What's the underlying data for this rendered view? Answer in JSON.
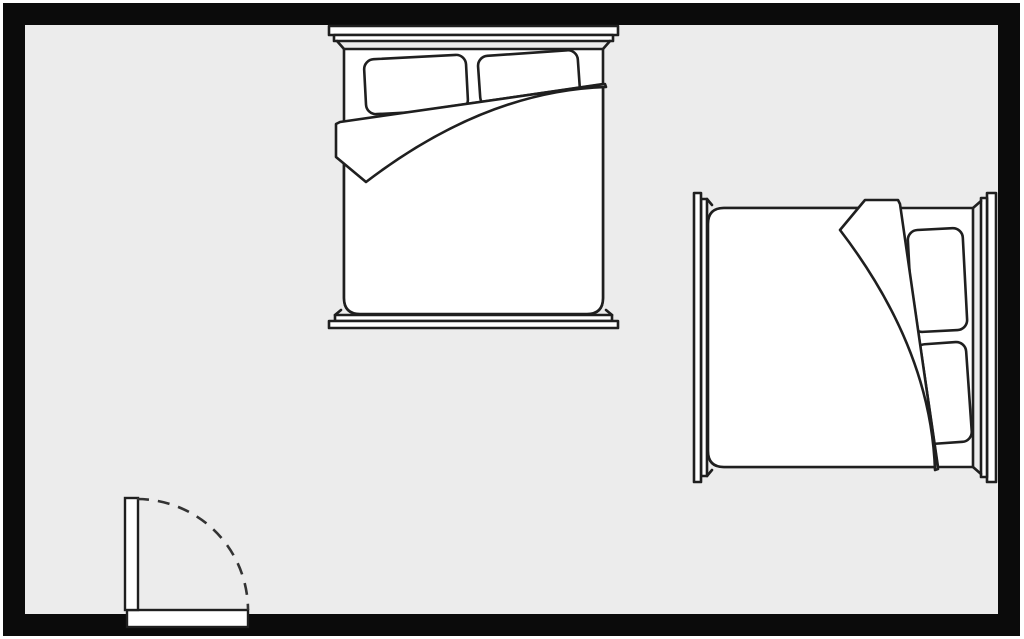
{
  "scene": {
    "description": "Bedroom floor plan: double bed against the top wall, single bed against the right wall, inward-swinging door at the bottom-left",
    "canvas": {
      "width": 1024,
      "height": 639
    },
    "colors": {
      "page_background": "#ffffff",
      "floor": "#ececec",
      "wall": "#0b0b0b",
      "furniture_line": "#1f1f1f",
      "furniture_fill": "#ffffff",
      "door_arc": "#333333"
    },
    "room": {
      "outer_x": 3,
      "outer_y": 3,
      "outer_width": 1017,
      "outer_height": 633,
      "wall_thickness": 22
    },
    "furniture": [
      {
        "id": "bed-top",
        "label": "bed against top wall",
        "x": 329,
        "y": 26,
        "rotation": 0
      },
      {
        "id": "bed-right",
        "label": "bed against right wall",
        "x": 996,
        "y": 193,
        "rotation": 90
      }
    ],
    "door": {
      "opening": {
        "x": 127,
        "y": 610,
        "width": 121,
        "height": 17
      },
      "leaf": {
        "x": 125,
        "y": 498,
        "width": 13,
        "height": 112
      },
      "swing": {
        "cx": 137,
        "cy": 610,
        "radius": 111,
        "style": "dashed-quarter-arc"
      }
    }
  }
}
